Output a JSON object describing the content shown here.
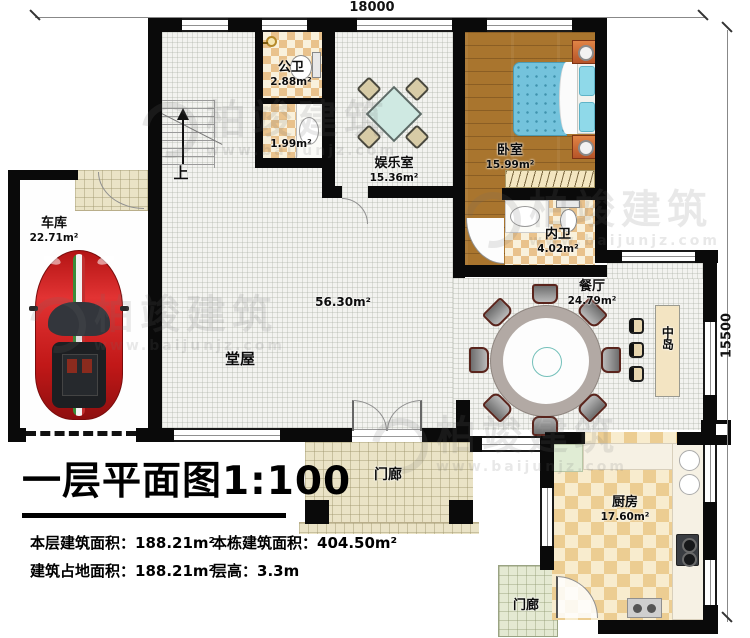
{
  "dimensions": {
    "top": "18000",
    "right": "15500"
  },
  "rooms": [
    {
      "name": "车库",
      "area": "22.71m²"
    },
    {
      "name": "公卫",
      "area": "2.88m²"
    },
    {
      "name": "",
      "area": "1.99m²"
    },
    {
      "name": "娱乐室",
      "area": "15.36m²"
    },
    {
      "name": "卧室",
      "area": "15.99m²"
    },
    {
      "name": "内卫",
      "area": "4.02m²"
    },
    {
      "name": "餐厅",
      "area": "24.79m²"
    },
    {
      "name": "中岛",
      "area": ""
    },
    {
      "name": "堂屋",
      "area": "56.30m²"
    },
    {
      "name": "门廊",
      "area": ""
    },
    {
      "name": "厨房",
      "area": "17.60m²"
    },
    {
      "name": "门廊",
      "area": ""
    }
  ],
  "stairs_label": "上",
  "title": "一层平面图1:100",
  "stats": [
    {
      "label": "本层建筑面积：",
      "value": "188.21m²"
    },
    {
      "label": "本栋建筑面积：",
      "value": "404.50m²"
    },
    {
      "label": "建筑占地面积：",
      "value": "188.21m²"
    },
    {
      "label": "层高：",
      "value": "3.3m"
    }
  ],
  "watermark": {
    "brand": "柏竣建筑",
    "url": "www.baijunjz.com"
  },
  "colors": {
    "wall": "#0a0a0a",
    "bed_blue": "#74c3dc",
    "pillow_cyan": "#8fd9e9",
    "car_red": "#cf1d1d",
    "checker_tan": "#e9c28c",
    "wood": "#a9752e",
    "porch_tile": "#eae3c6",
    "island_beige": "#f3e4c2"
  }
}
